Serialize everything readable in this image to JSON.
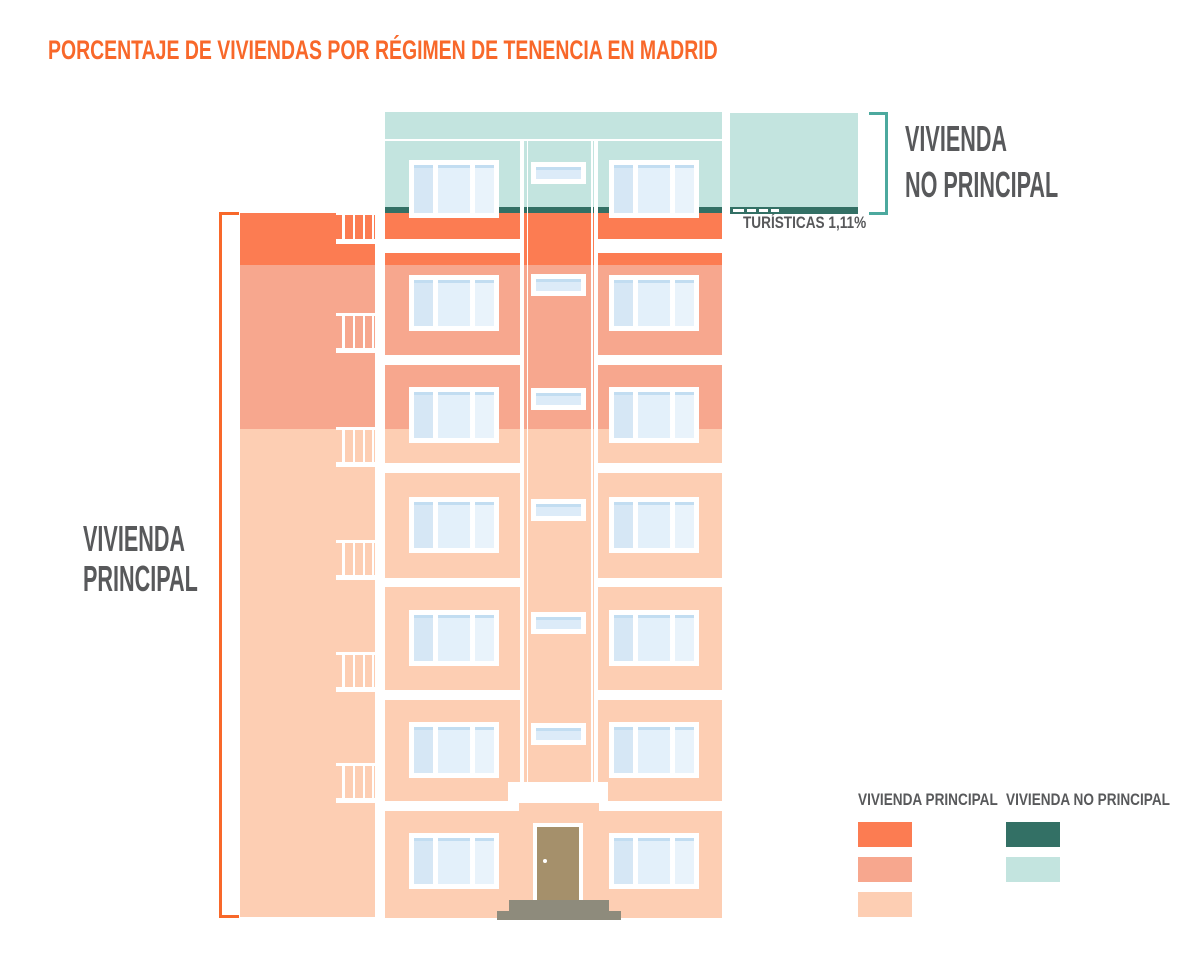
{
  "title": "PORCENTAJE DE VIVIENDAS POR RÉGIMEN DE TENENCIA EN MADRID",
  "chart_data": {
    "type": "bar",
    "title": "PORCENTAJE DE VIVIENDAS POR RÉGIMEN DE TENENCIA EN MADRID",
    "unit": "%",
    "representation": "stacked building pictogram",
    "groups": [
      {
        "name": "VIVIENDA PRINCIPAL",
        "segments": [
          {
            "label": "EN PROPIEDAD",
            "value": 60.52,
            "display": "60,52%",
            "color": "#FDCEB3"
          },
          {
            "label": "EN ALQUILER",
            "value": 20.73,
            "display": "20,73%",
            "color": "#F7A78E"
          },
          {
            "label": "OTRO RÉGIMEN",
            "value": 5.03,
            "display": "5,03%",
            "color": "#FC7C52"
          }
        ]
      },
      {
        "name": "VIVIENDA NO PRINCIPAL",
        "segments": [
          {
            "label": "OTROS",
            "value": 12.61,
            "display": "12,61%",
            "color": "#C3E4DF"
          },
          {
            "label": "TURÍSTICAS",
            "value": 1.11,
            "display": "1,11%",
            "color": "#337065"
          }
        ]
      }
    ]
  },
  "annotations": {
    "otro_regimen": {
      "name": "OTRO RÉGIMEN",
      "pct": "5,03%"
    },
    "en_alquiler": {
      "name": "EN ALQUILER",
      "pct": "20,73%"
    },
    "en_propiedad": {
      "name": "EN PROPIEDAD",
      "pct": "60,52%"
    },
    "otros": {
      "name": "OTROS",
      "pct": "12,61%"
    },
    "turisticas": "TURÍSTICAS 1,11%",
    "principal_bracket": {
      "line1": "VIVIENDA",
      "line2": "PRINCIPAL"
    },
    "no_principal_bracket": {
      "line1": "VIVIENDA",
      "line2": "NO PRINCIPAL"
    }
  },
  "legend": {
    "principal": {
      "title": "VIVIENDA PRINCIPAL",
      "swatches": [
        "#FC7C52",
        "#F7A78E",
        "#FDCEB3"
      ]
    },
    "no_principal": {
      "title": "VIVIENDA NO PRINCIPAL",
      "swatches": [
        "#337065",
        "#C3E4DF"
      ]
    }
  },
  "colors": {
    "accent_orange": "#F8682A",
    "band_orange": "#FC7C52",
    "band_salmon": "#F7A78E",
    "band_peach": "#FDCEB3",
    "teal_light": "#C3E4DF",
    "teal_dark": "#337065",
    "bracket_teal": "#4CA99E",
    "text_gray": "#58595B",
    "window_glass": "#DCEBF8",
    "window_accent": "#C2DDF1",
    "door_brown": "#A5906B",
    "steps_gray": "#8E8B7C",
    "background": "#FFFFFF"
  }
}
